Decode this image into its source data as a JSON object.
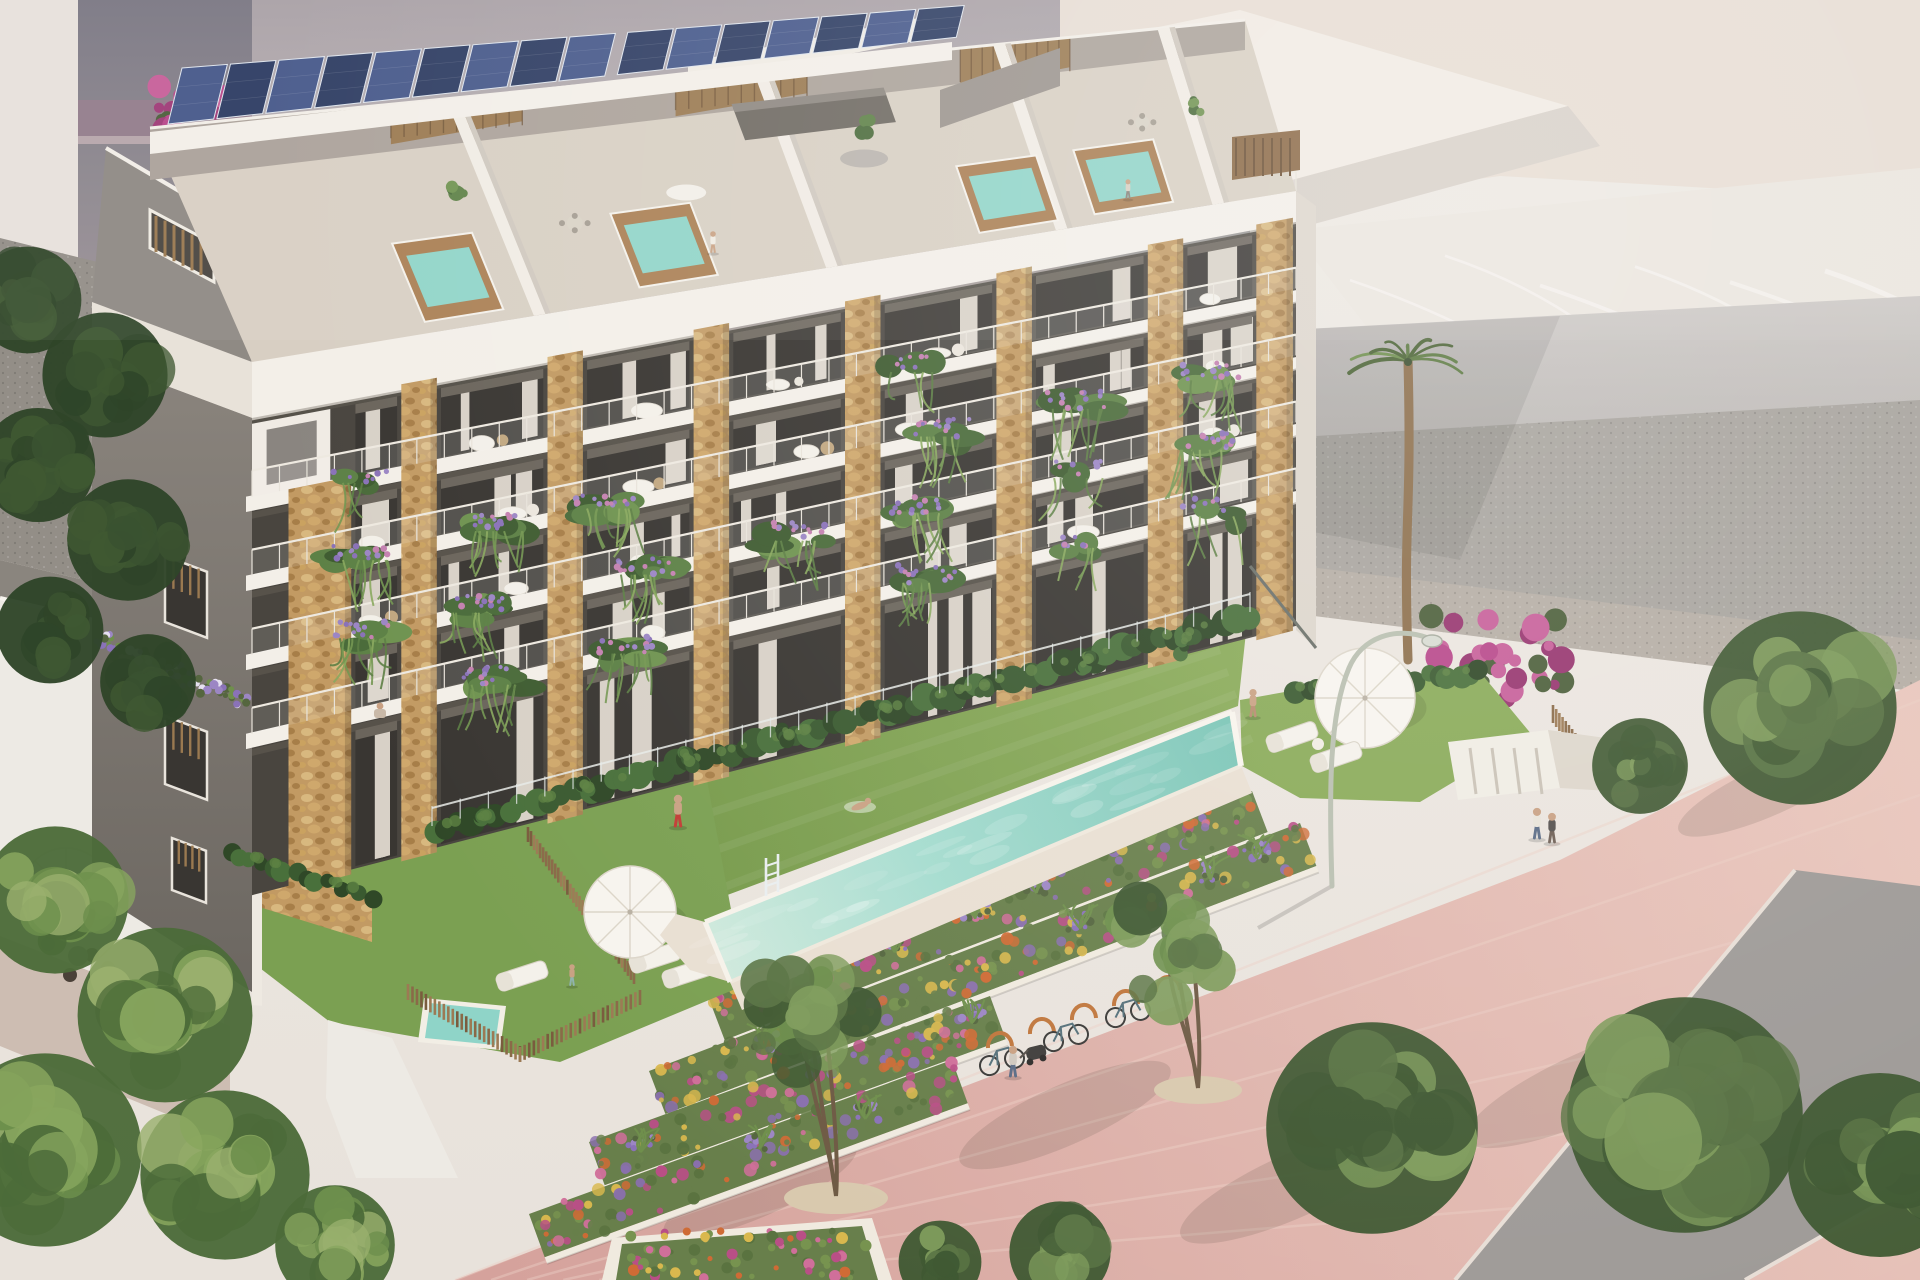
{
  "image": {
    "kind": "architectural-render",
    "view": "aerial-three-quarter",
    "subject": "modern apartment building with rooftop solar panels, stone-clad balcony piers, communal lap pool, flower terraces and pink promenade",
    "width": 1920,
    "height": 1280
  },
  "palette": {
    "sky": "#ece7e1",
    "bg_building_dark": "#83808a",
    "bg_band_mauve": "#937d8c",
    "bg_mid_top": "#a9a1a6",
    "bg_mid_bottom": "#c6bebf",
    "cream_wall": "#e7ddd3",
    "roof_plane_light": "#f1ebe3",
    "roof_plane_face": "#d8d0c8",
    "marble_light": "#ebe5de",
    "marble_dark": "#dcd6d0",
    "marble_face": "#c6c1be",
    "neighbor_wall_light": "#cbc7c4",
    "neighbor_wall_dark": "#a9a5a2",
    "gabion": "#a8a49e",
    "gravel": "#938e87",
    "gravel_warm": "#b5ada4",
    "white_wall": "#edeae4",
    "building_white": "#f3efe8",
    "building_white_shade": "#e4ded4",
    "slab_shadow": "#6d665c",
    "facade_recess": "#49453f",
    "glass_dark": "#393632",
    "curtain": "#d8d1c7",
    "stone_base": "#c29a63",
    "stone_light": "#d8b87f",
    "stone_dark": "#a77e48",
    "wood_slat": "#9a7950",
    "wood_dark": "#6b4f33",
    "solar_blue": "#2d3c62",
    "solar_blue_light": "#46588a",
    "solar_frame": "#dfe5ee",
    "terrace_floor": "#d8cfc3",
    "jacuzzi_wood": "#a97e52",
    "water_aqua": "#8fd4c8",
    "pool_shallow": "#cfe9dc",
    "pool_mid": "#a5dccf",
    "pool_deep": "#79c4b5",
    "deck": "#e9dfd2",
    "lawn_light": "#8aab59",
    "lawn_dark": "#6f9346",
    "hedge_dark": "#3a5a30",
    "hedge_mid": "#49703b",
    "foliage_dark": "#3f5832",
    "foliage_mid": "#5a7444",
    "foliage_light": "#7e9b5b",
    "conifer_dark": "#2f4529",
    "bed_green": "#687f4b",
    "flower_orange": "#cf6b35",
    "flower_pink": "#d06f9a",
    "flower_magenta": "#b94f86",
    "flower_purple": "#8a6fae",
    "lavender": "#9c86c4",
    "flower_yellow": "#d9b84e",
    "bougainvillea": "#b8478a",
    "promenade_pink": "#d5a29c",
    "promenade_pink_light": "#e9c6bc",
    "road_gray": "#9e9a97",
    "planter_wall": "#f0eadf",
    "umbrella_white": "#f7f4ee",
    "lamp_metal": "#b9bfb0",
    "rack_orange": "#c0763c",
    "skin": "#c9a183",
    "shorts_red": "#c23c35",
    "jeans_blue": "#5a6b85",
    "shadow": "#3e362e"
  },
  "scene": {
    "building": {
      "balcony_floors": 4,
      "window_bays": 7,
      "stone_piers": 8,
      "rooftop": {
        "solar_panels": 16,
        "jacuzzis": 4,
        "terrace_units": 4,
        "wood_slat_walls": 3
      }
    },
    "amenities": {
      "lap_pool": 1,
      "plunge_pool": 1,
      "parasols": 3,
      "sun_loungers": 5,
      "street_lamp": 1,
      "bike_racks": 5,
      "bicycles": 3,
      "pool_ladder": 1
    },
    "landscape": {
      "flower_terrace_rows": 4,
      "planter_square": 1,
      "palm_trees": 4,
      "promenade_trees": 6,
      "conifers": 6,
      "bougainvillea_clusters": 2
    },
    "people": [
      {
        "where": "rooftop-terrace"
      },
      {
        "where": "rooftop-terrace-right"
      },
      {
        "where": "upper-balcony-seated"
      },
      {
        "where": "lawn-jogger"
      },
      {
        "where": "pool-swimmer"
      },
      {
        "where": "poolside-standing"
      },
      {
        "where": "promenade-couple-a"
      },
      {
        "where": "promenade-couple-b"
      },
      {
        "where": "promenade-stroller"
      },
      {
        "where": "private-garden"
      }
    ]
  }
}
